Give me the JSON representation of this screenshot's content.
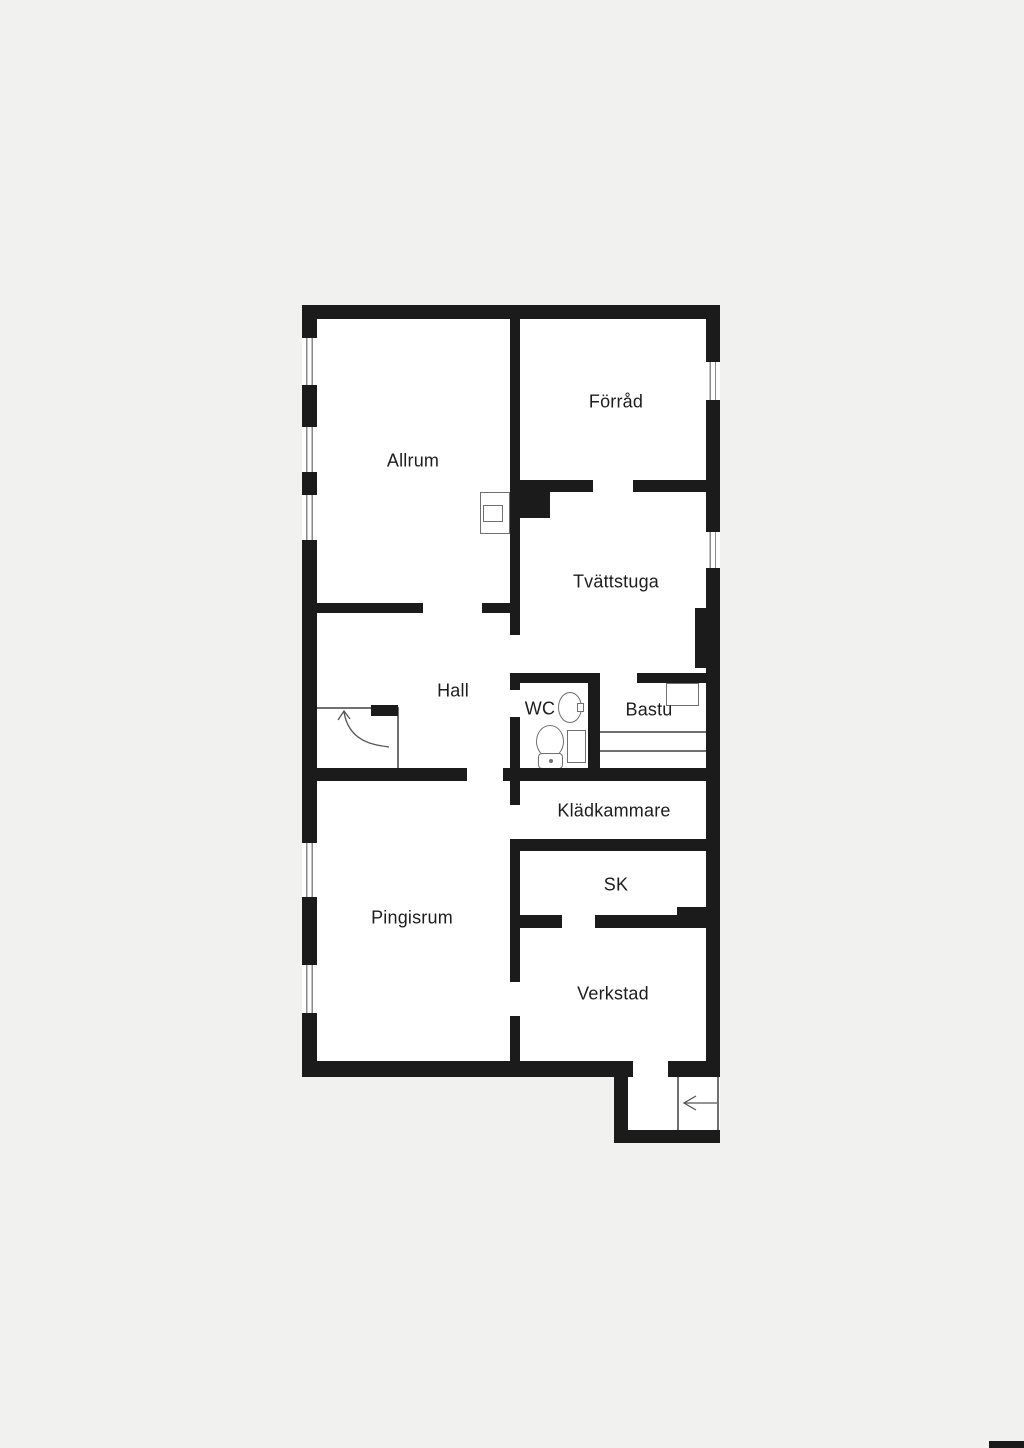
{
  "palette": {
    "background": "#f1f1ef",
    "wall": "#1b1b1b",
    "floor": "#ffffff",
    "fixture_line": "#707070",
    "window_line": "#8a8a8a",
    "label_text": "#1d1d1d"
  },
  "floorplan": {
    "rooms": [
      {
        "id": "allrum",
        "label": "Allrum"
      },
      {
        "id": "forrad",
        "label": "Förråd"
      },
      {
        "id": "tvattstuga",
        "label": "Tvättstuga"
      },
      {
        "id": "hall",
        "label": "Hall"
      },
      {
        "id": "wc",
        "label": "WC"
      },
      {
        "id": "bastu",
        "label": "Bastu"
      },
      {
        "id": "kladkammare",
        "label": "Klädkammare"
      },
      {
        "id": "sk",
        "label": "SK"
      },
      {
        "id": "pingisrum",
        "label": "Pingisrum"
      },
      {
        "id": "verkstad",
        "label": "Verkstad"
      }
    ],
    "symbols": [
      "window",
      "stairs-up-arrow",
      "entry-arrow",
      "fireplace",
      "chimney",
      "toilet",
      "sink",
      "sauna-bench",
      "sauna-heater"
    ]
  }
}
